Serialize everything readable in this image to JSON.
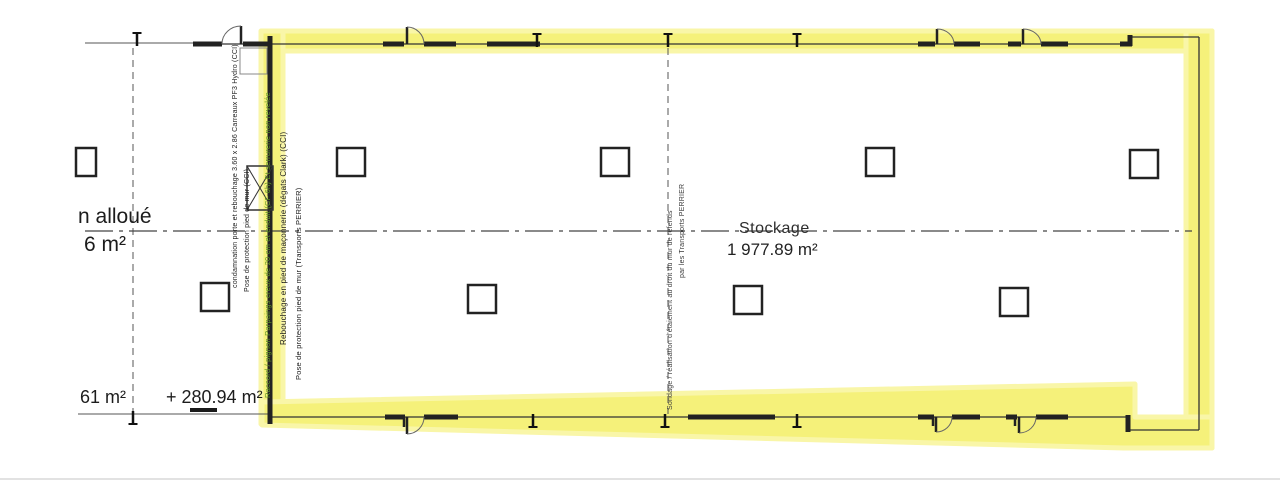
{
  "plan": {
    "room": {
      "label": "Stockage",
      "area": "1 977.89 m²"
    },
    "left_zone": {
      "label_line1": "n alloué",
      "label_line2": "6 m²"
    },
    "bottom_dims": {
      "area_left": "61 m²",
      "area_added": "+ 280.94 m²"
    },
    "annotations": {
      "left_wall": [
        {
          "text": "condamnation porte et rebouchage 3.60 x 2.86  Carreaux PF3 Hydro (CCI)",
          "color": "#1c1c1c"
        },
        {
          "text": "Pose de protection pied de mur (CCI)",
          "color": "#1c1c1c"
        },
        {
          "text": "Raccord / pignon Parpaings creux de 20 cm et enduit (CF 6h) Et serrurerie non revelée",
          "color": "#5f9426"
        },
        {
          "text": "Rebouchage en pied de maçonnerie (dégats Clark) (CCI)",
          "color": "#1c1c1c"
        },
        {
          "text": "Pose de protection pied de mur (Transports PERRIER)",
          "color": "#1c1c1c"
        }
      ],
      "middle_wall": [
        {
          "text": "Sondage / réalisation d'étaiement au droit du mur de refends",
          "color": "#3a3a3a"
        },
        {
          "text": "par les Transports PERRIER",
          "color": "#3a3a3a"
        }
      ]
    },
    "colors": {
      "highlight": "#f5f17a",
      "highlight_edge": "#f9f6a8",
      "wall": "#222222",
      "annotation_green": "#5f9426"
    }
  }
}
